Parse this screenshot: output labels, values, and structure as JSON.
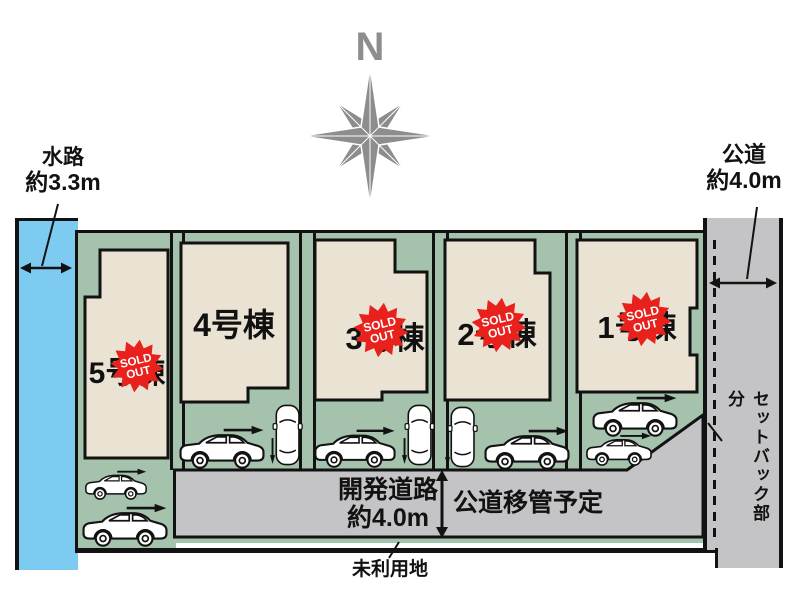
{
  "compass": {
    "north": "N"
  },
  "annotations": {
    "waterway": {
      "name": "水路",
      "size": "約3.3m"
    },
    "public_road": {
      "name": "公道",
      "size": "約4.0m"
    },
    "dev_road": {
      "name": "開発道路",
      "size": "約4.0m"
    },
    "road_transfer": "公道移管予定",
    "setback": "セットバック部分",
    "unused_land": "未利用地"
  },
  "lots": [
    {
      "label": "1号棟",
      "sold": true
    },
    {
      "label": "2号棟",
      "sold": true
    },
    {
      "label": "3号棟",
      "sold": true
    },
    {
      "label": "4号棟",
      "sold": false
    },
    {
      "label": "5号棟",
      "sold": true
    }
  ],
  "badge": {
    "line1": "SOLD",
    "line2": "OUT"
  },
  "colors": {
    "lot_green": "#a4c2ac",
    "building_beige": "#eae3d3",
    "road_gray": "#c4c4c6",
    "water_blue": "#7ecbf2",
    "sold_red": "#e8211d",
    "compass_gray": "#8d8d8d"
  }
}
